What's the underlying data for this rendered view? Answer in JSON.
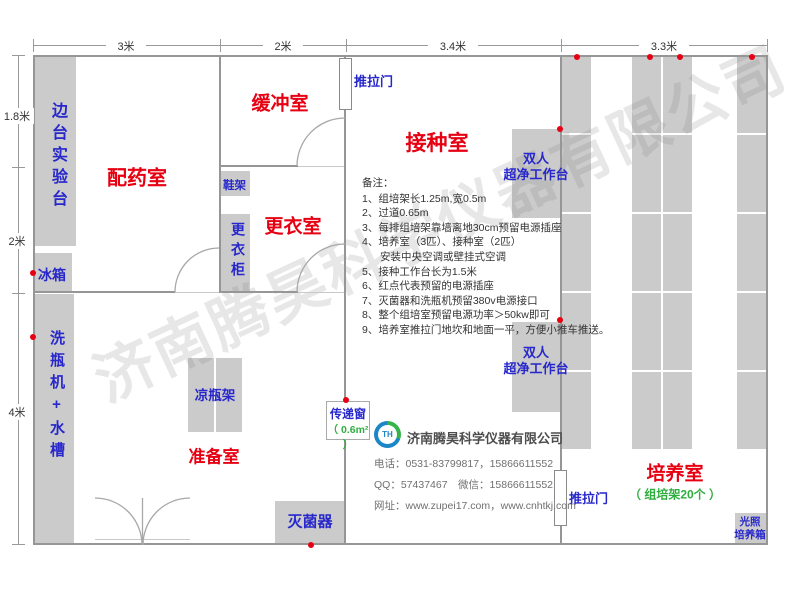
{
  "colors": {
    "room_label_red": "#e60012",
    "equipment_label_blue": "#2727cc",
    "green": "#2fae3f",
    "outlet_dot_red": "#e60012",
    "furniture_gray": "#cbcbcb",
    "wall_gray": "#969696"
  },
  "watermark": "济南腾昊科学仪器有限公司",
  "dimensions": {
    "top": [
      "3米",
      "2米",
      "3.4米",
      "3.3米"
    ],
    "left": [
      "1.8米",
      "2米",
      "4米"
    ]
  },
  "rooms": {
    "dispensing": "配药室",
    "buffer": "缓冲室",
    "changing": "更衣室",
    "inoculation": "接种室",
    "preparation": "准备室",
    "culture": "培养室",
    "culture_sub": "（ 组培架20个 ）"
  },
  "equipment": {
    "side_bench": "边台实验台",
    "fridge": "冰箱",
    "bottle_washer_sink": "洗瓶机+水槽",
    "shoe_rack": "鞋架",
    "locker": "更衣柜",
    "bottle_cooling_rack": "凉瓶架",
    "sterilizer": "灭菌器",
    "clean_bench_line1": "双人",
    "clean_bench_line2": "超净工作台",
    "sliding_door": "推拉门",
    "pass_window": "传递窗",
    "pass_window_area": "（ 0.6m² ）",
    "light_incubator_line1": "光照",
    "light_incubator_line2": "培养箱"
  },
  "notes": {
    "title": "备注：",
    "items": [
      "1、组培架长1.25m,宽0.5m",
      "2、过道0.65m",
      "3、每排组培架靠墙离地30cm预留电源插座",
      "4、培养室（3匹）、接种室（2匹）",
      "安装中央空调或壁挂式空调",
      "5、接种工作台长为1.5米",
      "6、红点代表预留的电源插座",
      "7、灭菌器和洗瓶机预留380v电源接口",
      "8、整个组培室预留电源功率＞50kw即可",
      "9、培养室推拉门地坎和地面一平，方便小推车推送。"
    ]
  },
  "company": {
    "logo_text": "TH",
    "name": "济南腾昊科学仪器有限公司",
    "phone_line": "电话：0531-83799817，15866611552",
    "qq_line": "QQ：57437467　微信：15866611552",
    "web_line": "网址：www.zupei17.com，www.cnhtkj.com"
  },
  "power_outlets": {
    "legend": "红点代表预留的电源插座",
    "positions": [
      {
        "x": 33,
        "y": 273
      },
      {
        "x": 33,
        "y": 337
      },
      {
        "x": 311,
        "y": 545
      },
      {
        "x": 346,
        "y": 400
      },
      {
        "x": 560,
        "y": 129
      },
      {
        "x": 560,
        "y": 320
      },
      {
        "x": 577,
        "y": 57
      },
      {
        "x": 650,
        "y": 57
      },
      {
        "x": 680,
        "y": 57
      },
      {
        "x": 752,
        "y": 57
      }
    ]
  }
}
